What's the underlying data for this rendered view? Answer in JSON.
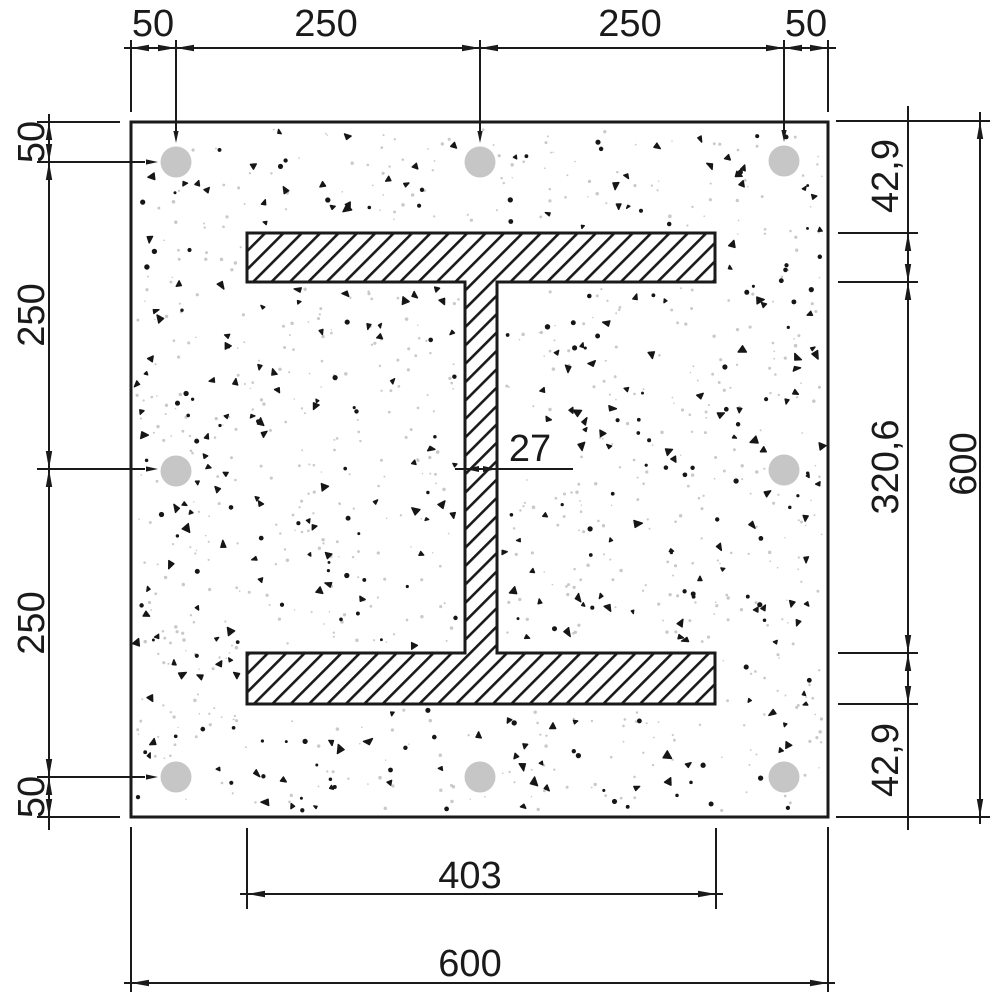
{
  "drawing": {
    "kind": "reinforced-concrete-column-cross-section-with-steel-I-profile",
    "dimensions": {
      "top": [
        "50",
        "250",
        "250",
        "50"
      ],
      "left": [
        "50",
        "250",
        "250",
        "50"
      ],
      "right_chain": [
        "42,9",
        "320,6",
        "42,9"
      ],
      "right_total": "600",
      "bottom_flange_width": "403",
      "bottom_total": "600",
      "web_thickness": "27"
    },
    "colors": {
      "line": "#1a1a1a",
      "rebar_fill": "#c6c6c6",
      "speck_dark": "#161616",
      "speck_light": "#c3c3c3",
      "background": "#ffffff"
    }
  }
}
